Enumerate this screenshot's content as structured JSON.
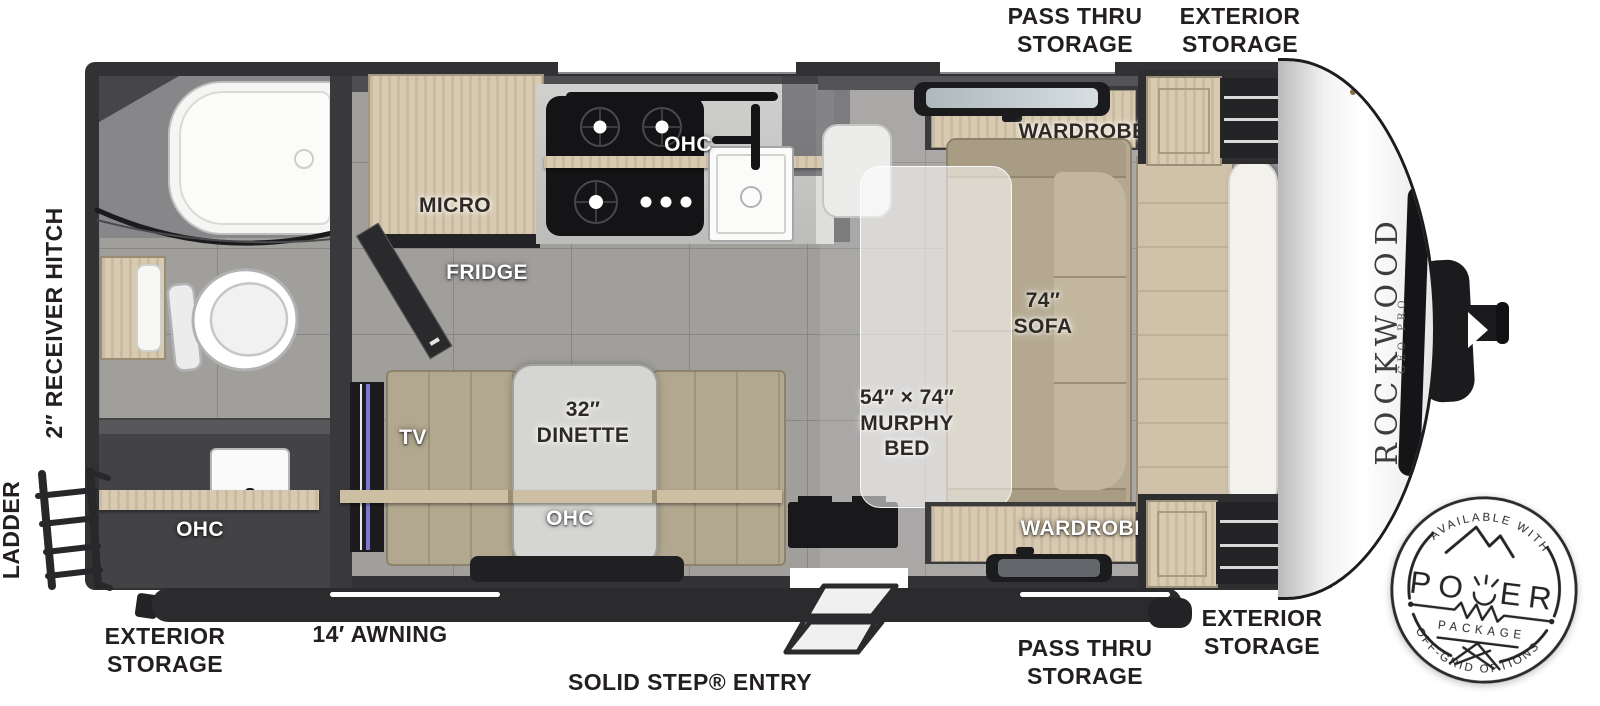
{
  "labels": {
    "top_pass_thru": "PASS THRU\nSTORAGE",
    "top_exterior": "EXTERIOR\nSTORAGE",
    "receiver_hitch": "2″ RECEIVER HITCH",
    "ladder": "LADDER",
    "bottom_exterior_left": "EXTERIOR\nSTORAGE",
    "awning": "14′ AWNING",
    "entry": "SOLID STEP® ENTRY",
    "bottom_pass_thru": "PASS THRU\nSTORAGE",
    "bottom_exterior_right": "EXTERIOR\nSTORAGE"
  },
  "interior": {
    "bath_ohc": "OHC",
    "micro": "MICRO",
    "fridge": "FRIDGE",
    "kitchen_ohc": "OHC",
    "tv": "TV",
    "dinette": "32″\nDINETTE",
    "dinette_ohc": "OHC",
    "wardrobe_top": "WARDROBE",
    "wardrobe_bottom": "WARDROBE",
    "sofa": "74″\nSOFA",
    "murphy_bed": "54″ × 74″\nMURPHY\nBED"
  },
  "brand": {
    "name": "ROCKWOOD",
    "sub": "GEO PRO"
  },
  "badge": {
    "arc_top": "AVAILABLE WITH",
    "power_left": "PO",
    "power_right": "ER",
    "package": "PACKAGE",
    "arc_bottom": "OFF-GRID OPTIONS"
  },
  "colors": {
    "wall": "#333335",
    "floor": "#a19f9c",
    "wood": "#d8cbb2",
    "cushion": "#b4a990",
    "accent": "#7b79d2"
  }
}
